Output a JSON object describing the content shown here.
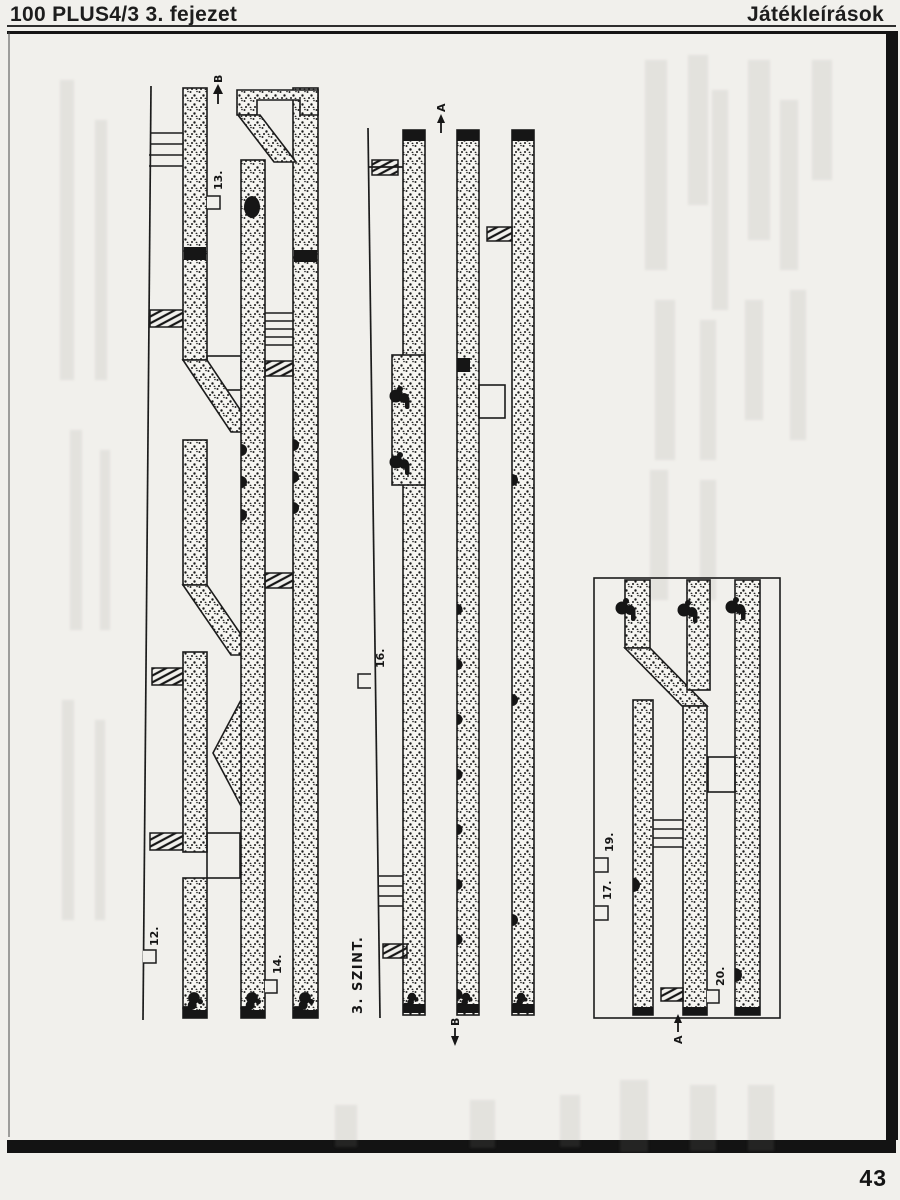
{
  "header": {
    "left_title": "100 PLUS4/3  3. fejezet",
    "right_title": "Játékleírások"
  },
  "footer": {
    "page_number": "43"
  },
  "map": {
    "level_label": "3. SZINT.",
    "labels": {
      "l12": "12.",
      "l13": "13.",
      "l14": "14.",
      "l16": "16.",
      "l17": "17.",
      "l19": "19.",
      "l20": "20."
    },
    "arrows": {
      "top_b": "B",
      "top_a": "A",
      "bottom_b": "B",
      "bottom_a": "A"
    }
  },
  "colors": {
    "ink": "#1c1c1c",
    "paper": "#f1f0ec"
  }
}
